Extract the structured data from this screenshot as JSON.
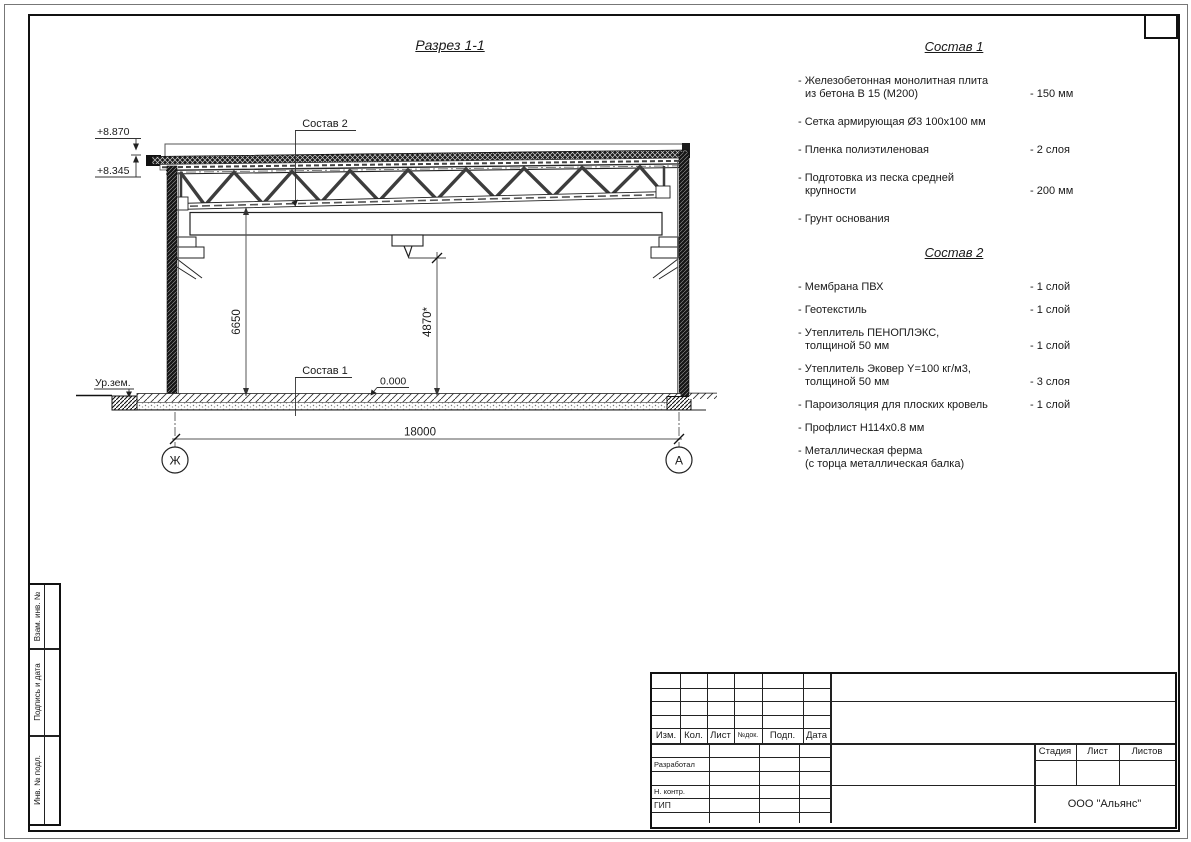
{
  "drawing": {
    "title": "Разрез 1-1",
    "callouts": {
      "sostav1": "Состав 1",
      "sostav2": "Состав 2"
    },
    "levels": {
      "parapet": "+8.870",
      "roof": "+8.345",
      "zero": "0.000",
      "ground": "Ур.зем."
    },
    "dims": {
      "truss_bottom": "6650",
      "hook": "4870*",
      "span": "18000"
    },
    "axes": {
      "left": "Ж",
      "right": "А"
    }
  },
  "spec1": {
    "title": "Состав 1",
    "items": [
      {
        "line1": "- Железобетонная  монолитная плита",
        "line2": "из бетона В 15 (М200)",
        "value": "- 150 мм"
      },
      {
        "line1": "- Сетка армирующая Ø3 100х100 мм",
        "value": ""
      },
      {
        "line1": "- Пленка полиэтиленовая",
        "value": "- 2 слоя"
      },
      {
        "line1": "- Подготовка из песка средней",
        "line2": "крупности",
        "value": "- 200 мм"
      },
      {
        "line1": "- Грунт основания",
        "value": ""
      }
    ]
  },
  "spec2": {
    "title": "Состав 2",
    "items": [
      {
        "line1": "- Мембрана ПВХ",
        "value": "- 1 слой"
      },
      {
        "line1": "- Геотекстиль",
        "value": "- 1 слой"
      },
      {
        "line1": "- Утеплитель ПЕНОПЛЭКС,",
        "line2": "толщиной 50 мм",
        "value": "- 1 слой"
      },
      {
        "line1": "- Утеплитель Эковер Y=100 кг/м3,",
        "line2": "толщиной 50 мм",
        "value": "- 3 слоя"
      },
      {
        "line1": "- Пароизоляция для плоских кровель",
        "value": "- 1 слой"
      },
      {
        "line1": "- Профлист Н114х0.8 мм",
        "value": ""
      },
      {
        "line1": "- Металлическая ферма",
        "line2": "(с торца металлическая балка)",
        "value": ""
      }
    ]
  },
  "titleblock": {
    "header_cols": [
      "Изм.",
      "Кол.",
      "Лист",
      "№док.",
      "Подп.",
      "Дата"
    ],
    "roles": [
      "Разработал",
      "Н. контр.",
      "ГИП"
    ],
    "stamp_cols": [
      "Стадия",
      "Лист",
      "Листов"
    ],
    "company": "ООО \"Альянс\""
  },
  "sidebar": {
    "items": [
      "Взам. инв. №",
      "Подпись и дата",
      "Инв. № подл."
    ]
  },
  "colors": {
    "line_main": "#1a1a1a",
    "line_dim": "#555",
    "paper": "#ffffff"
  }
}
